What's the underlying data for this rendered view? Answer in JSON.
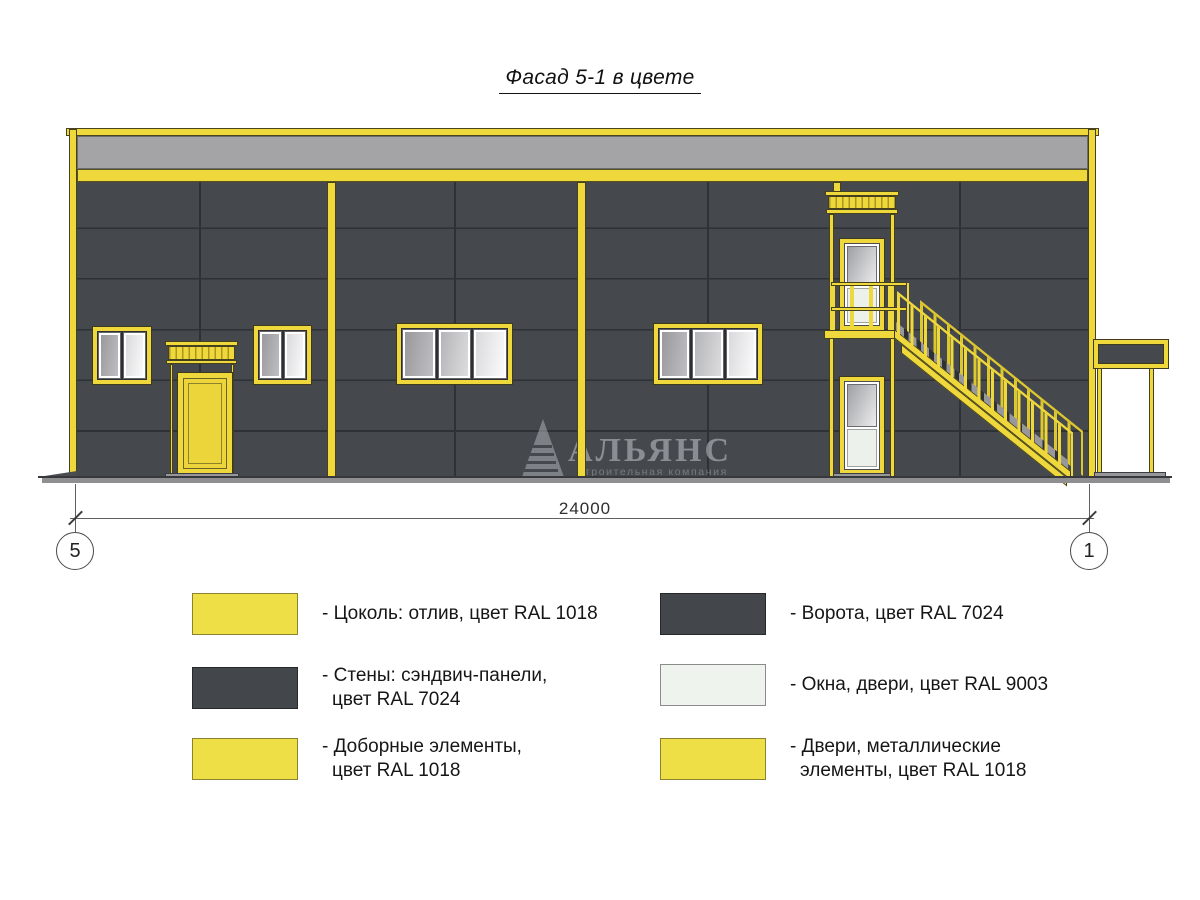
{
  "title": "Фасад 5-1 в цвете",
  "facade": {
    "dimension_label": "24000",
    "axis_left": "5",
    "axis_right": "1",
    "watermark_title": "АЛЬЯНС",
    "watermark_subtitle": "строительная компания"
  },
  "legend": {
    "left": [
      {
        "swatch_color_name": "RAL 1018 yellow",
        "lines": [
          "- Цоколь: отлив, цвет RAL 1018"
        ]
      },
      {
        "swatch_color_name": "RAL 7024 grey",
        "lines": [
          "- Стены: сэндвич-панели,",
          "цвет RAL 7024"
        ]
      },
      {
        "swatch_color_name": "RAL 1018 yellow",
        "lines": [
          "- Доборные элементы,",
          "цвет RAL 1018"
        ]
      }
    ],
    "right": [
      {
        "swatch_color_name": "RAL 7024 grey",
        "lines": [
          "- Ворота, цвет RAL 7024"
        ]
      },
      {
        "swatch_color_name": "RAL 9003 white",
        "lines": [
          "- Окна, двери, цвет RAL 9003"
        ]
      },
      {
        "swatch_color_name": "RAL 1018 yellow",
        "lines": [
          "- Двери, металлические",
          "элементы, цвет RAL 1018"
        ]
      }
    ]
  },
  "colors": {
    "ral_1018_yellow": "#EFD83C",
    "ral_7024_wall_grey": "#45484D",
    "ral_9003_window_white": "#EFF3EE",
    "fascia_grey": "#A4A4A6",
    "ground_grey": "#8F8F92",
    "seam_dark": "#2E3135",
    "outline_dark": "#3F3A1C"
  }
}
